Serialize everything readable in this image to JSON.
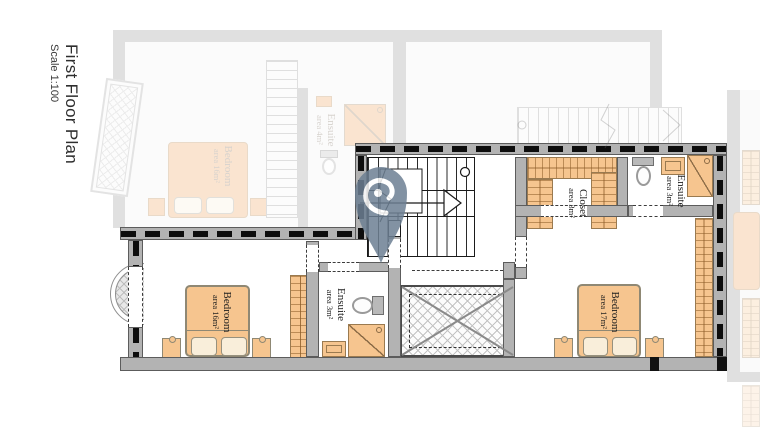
{
  "title": {
    "main": "First Floor Plan",
    "scale": "Scale 1:100"
  },
  "rooms": {
    "bedroom_left": {
      "name": "Bedroom",
      "area": "area 16m²"
    },
    "ensuite_middle": {
      "name": "Ensuite",
      "area": "area 3m²"
    },
    "closet": {
      "name": "Closet",
      "area": "area 3m²"
    },
    "ensuite_right": {
      "name": "Ensuite",
      "area": "area 3m²"
    },
    "bedroom_right": {
      "name": "Bedroom",
      "area": "area 17m²"
    }
  },
  "ghost_rooms": {
    "bedroom": {
      "name": "Bedroom",
      "area": "area 16m²"
    },
    "ensuite": {
      "name": "Ensuite",
      "area": "area 4m²"
    }
  },
  "marker": {
    "label": "location-pin"
  },
  "colors": {
    "furniture_orange": "#f6c58f",
    "wall_gray": "#b3b3b3",
    "dash_black": "#111111",
    "pin_slate_blue": "#6d8093",
    "ghost_gray": "#d9d9d9"
  }
}
